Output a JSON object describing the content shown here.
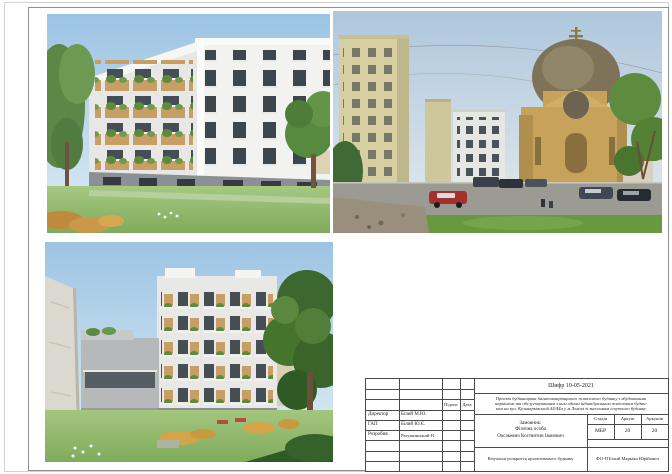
{
  "palette": {
    "sky": "#a9cde8",
    "lawn": "#8fba6b",
    "facade_white": "#f2f3f1",
    "facade_grey": "#b6b9ba",
    "balcony_wood": "#c79e63",
    "foliage": "#55813c",
    "church_wall": "#c6a25b",
    "church_dome": "#7e7359",
    "road": "#9b9a93",
    "red_car": "#a4312b",
    "frame_line": "#8f8f8d"
  },
  "figures": {
    "top_left": "render-building-street-view",
    "top_right": "photo-site-context-church",
    "bottom_left": "render-building-courtyard-view"
  },
  "title_block": {
    "code": "Шифр 10-05-2021",
    "description_lines": [
      "Проект будівництва багатоквартирного житлового будинку з вбудованими",
      "паркінгом та обслуговуванням з ним одним індивідуальним житловим будин-",
      "ком на вул. Кульпарківській 44/44а у м.Львові зі знесенням існуючого будинку"
    ],
    "signature_columns": {
      "signature": "Підпис",
      "date": "Дата"
    },
    "signatories": [
      {
        "role": "Директор",
        "name": "Білий М.Ю."
      },
      {
        "role": "ГАП",
        "name": "Білий Ю.Є."
      },
      {
        "role": "Розробив",
        "name": "Ратушинський Н."
      }
    ],
    "client": {
      "label": "Замовник:",
      "line1": "Фізична особа",
      "line2": "Оксакевич Костянтин Іванович"
    },
    "stage": {
      "headers": [
        "Стадія",
        "Аркуш",
        "Аркушів"
      ],
      "values": [
        "МБР",
        "20",
        "20"
      ]
    },
    "sheet_title": "Візуальні розкриття проектованого будинку",
    "author_company": "ФО-П Білий Маркіян Юрійович"
  }
}
